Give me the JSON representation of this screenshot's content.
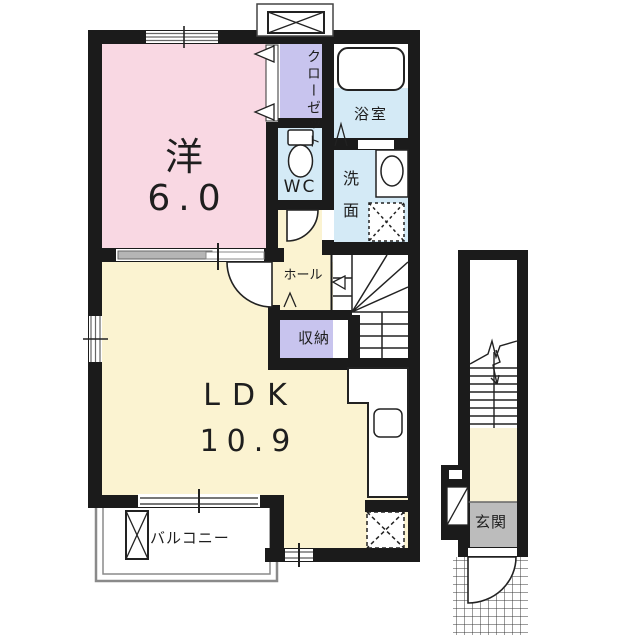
{
  "floorplan": {
    "rooms": {
      "western": {
        "label": "洋",
        "size": "6.0"
      },
      "ldk": {
        "label": "LDK",
        "size": "10.9"
      },
      "closet": {
        "label": "クローゼット"
      },
      "bathroom": {
        "label": "浴室"
      },
      "wc": {
        "label": "WC"
      },
      "washroom": {
        "label": "洗面"
      },
      "hall": {
        "label": "ホール"
      },
      "storage": {
        "label": "収納"
      },
      "balcony": {
        "label": "バルコニー"
      },
      "entrance": {
        "label": "玄関"
      }
    },
    "colors": {
      "wall": "#1b1b1b",
      "western_room_fill": "#f9d8e3",
      "ldk_fill": "#fbf3d1",
      "closet_fill": "#c8c4ee",
      "wet_area_fill": "#d4eaf6",
      "entrance_floor_fill": "#bcbcbc",
      "balcony_line": "#8a8a8a"
    }
  }
}
